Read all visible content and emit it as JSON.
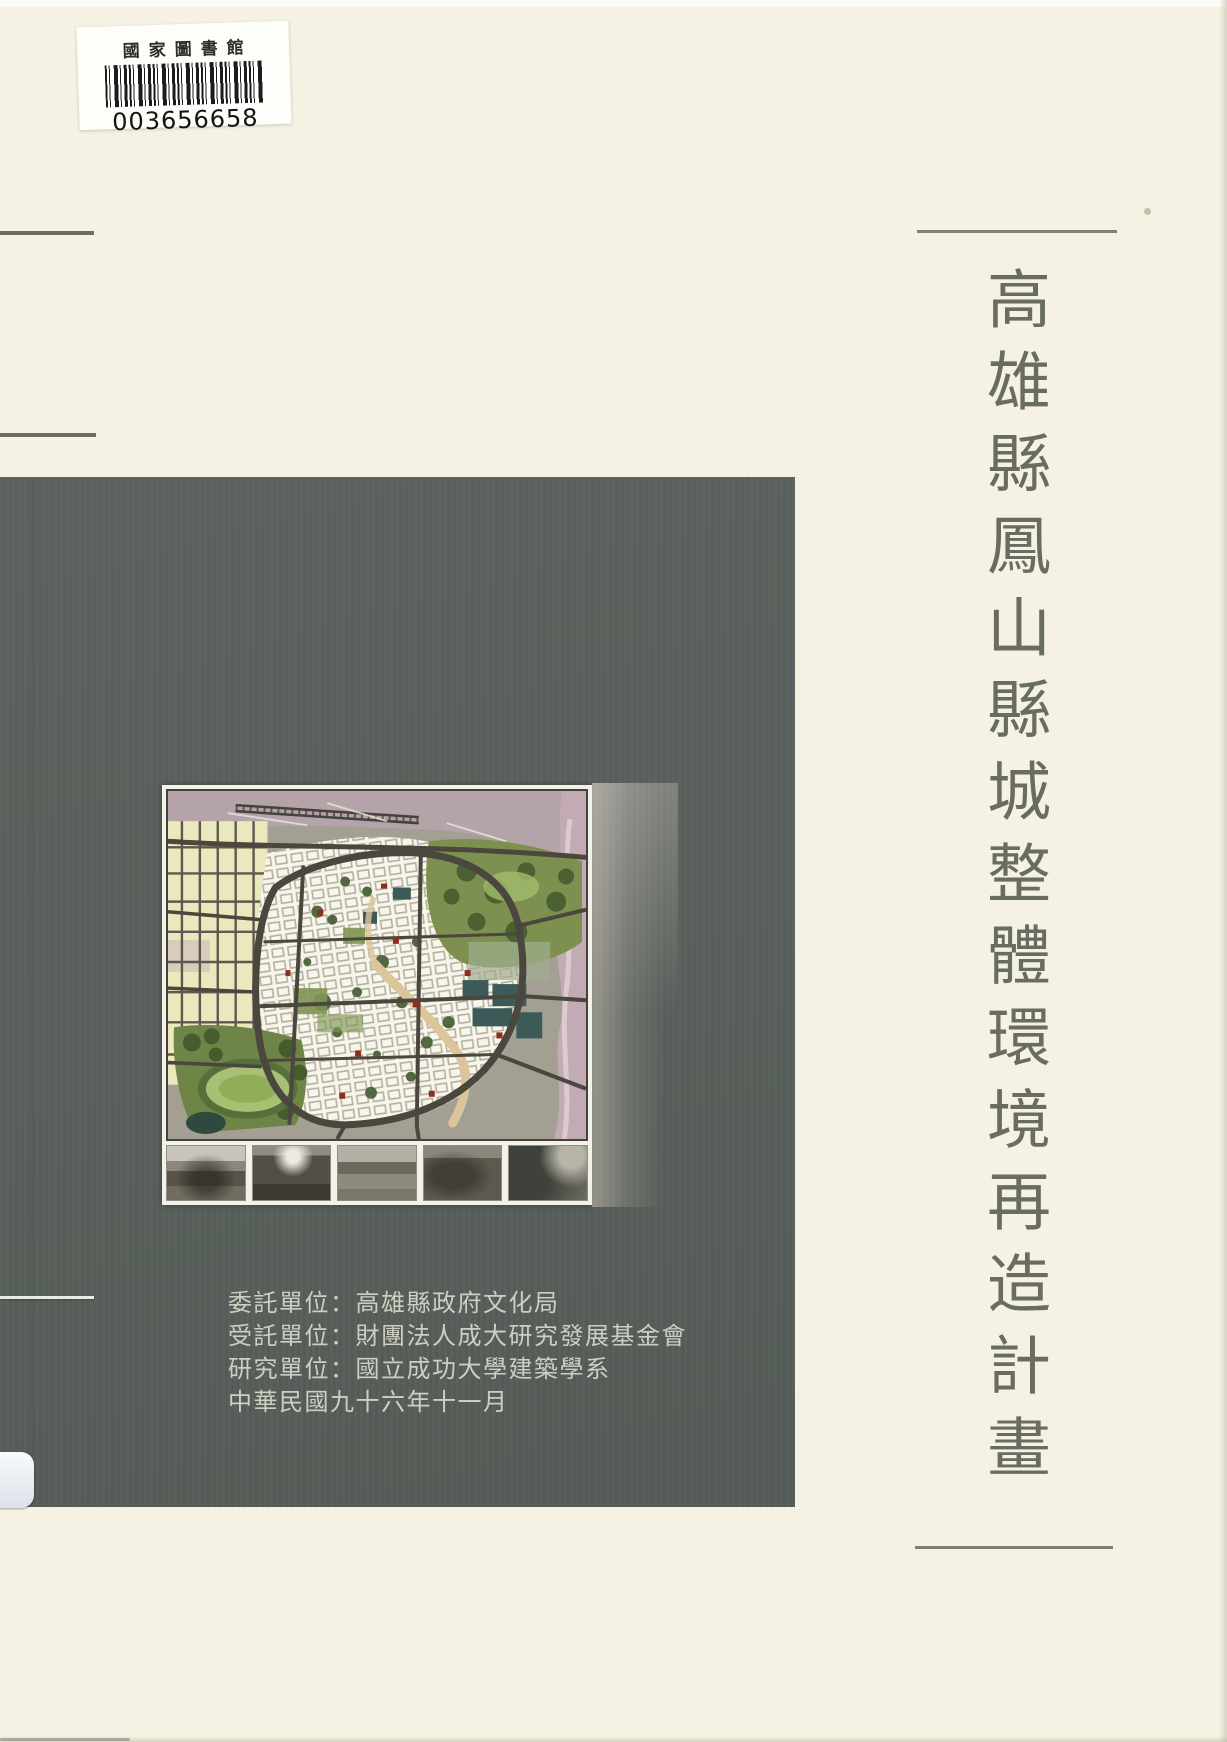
{
  "page": {
    "background_color": "#f5f2e3",
    "panel_color": "#59605b",
    "title_color": "#696c60",
    "credits_color": "#cdcfc3"
  },
  "library_label": {
    "title": "國家圖書館",
    "barcode_number": "003656658"
  },
  "cover_title": {
    "text": "高雄縣鳳山縣城整體環境再造計畫"
  },
  "panel": {
    "credits": [
      "委託單位：高雄縣政府文化局",
      "受託單位：財團法人成大研究發展基金會",
      "研究單位：國立成功大學建築學系",
      "中華民國九十六年十一月"
    ]
  }
}
